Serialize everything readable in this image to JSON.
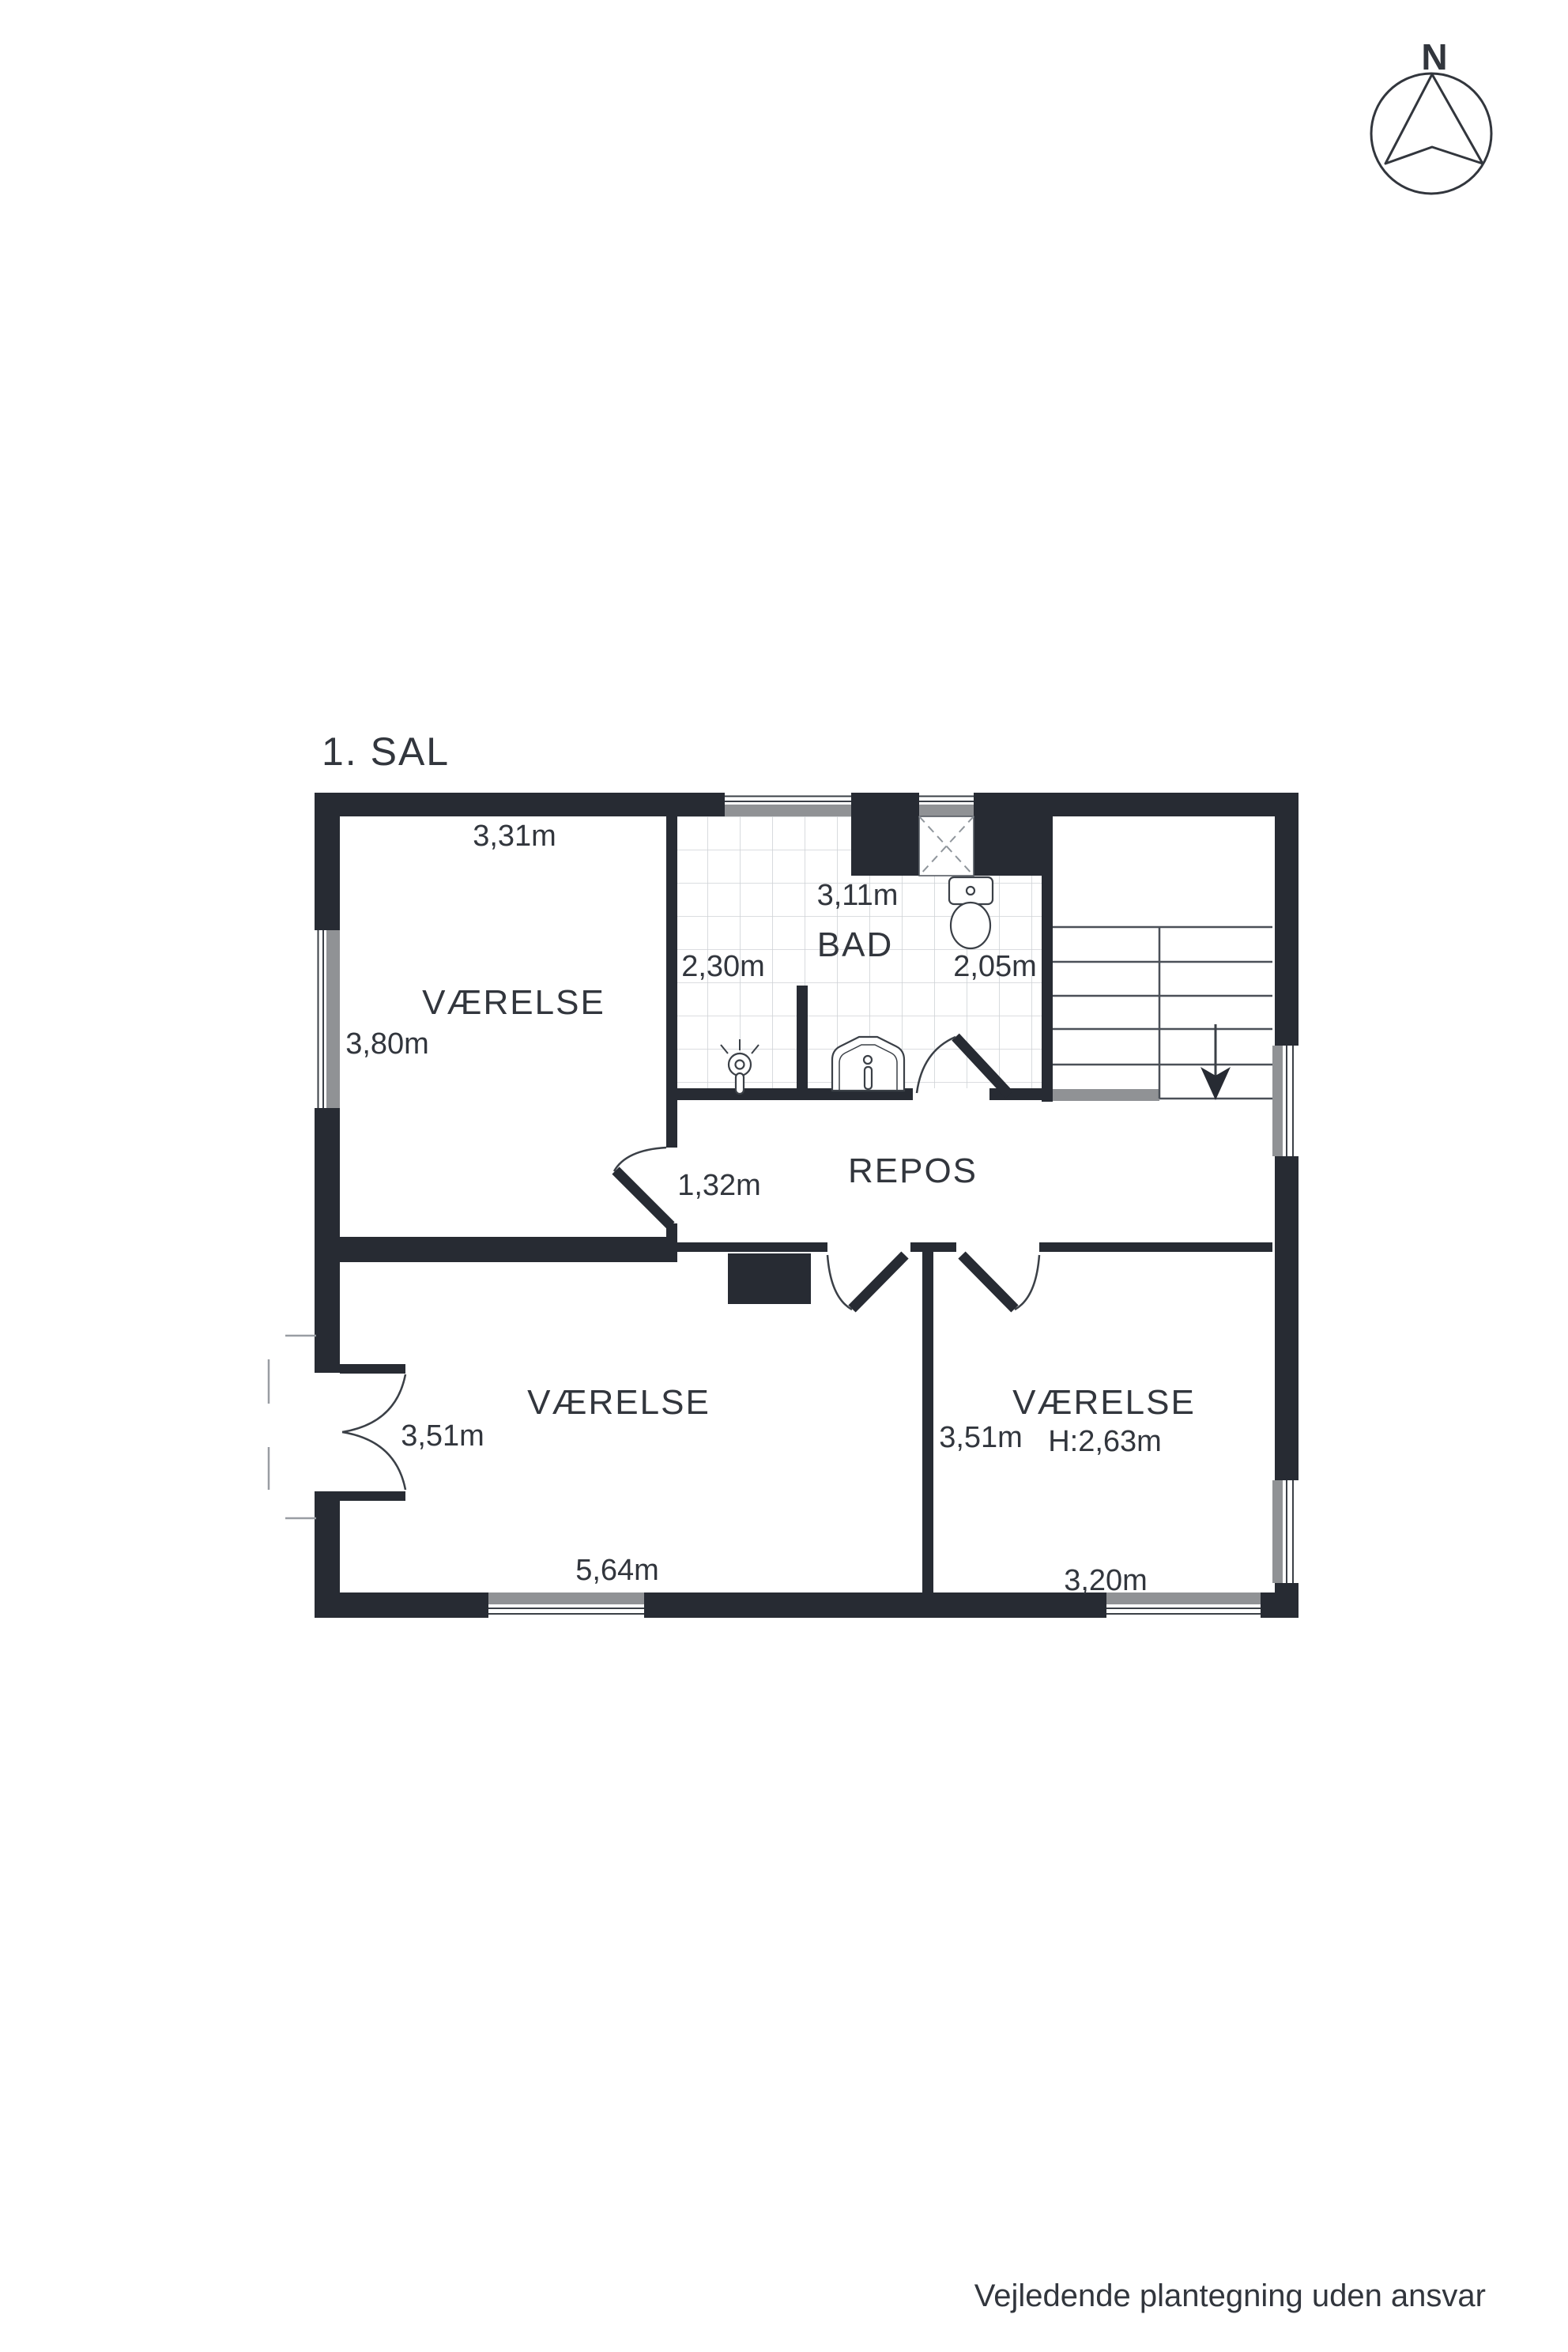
{
  "title": "1. SAL",
  "footer": "Vejledende plantegning uden ansvar",
  "compass_label": "N",
  "colors": {
    "wall": "#272b33",
    "sill": "#909295",
    "text": "#32363d",
    "tile_line": "#cfd2d6"
  },
  "rooms": {
    "nw": {
      "name": "VÆRELSE",
      "width": "3,31m",
      "depth": "3,80m"
    },
    "bad": {
      "name": "BAD",
      "width": "3,11m",
      "left": "2,30m",
      "right": "2,05m"
    },
    "repos": {
      "name": "REPOS",
      "passage": "1,32m"
    },
    "sw": {
      "name": "VÆRELSE",
      "depth": "3,51m",
      "width": "5,64m"
    },
    "se": {
      "name": "VÆRELSE",
      "depth": "3,51m",
      "ceiling_height": "H:2,63m",
      "width": "3,20m"
    }
  }
}
